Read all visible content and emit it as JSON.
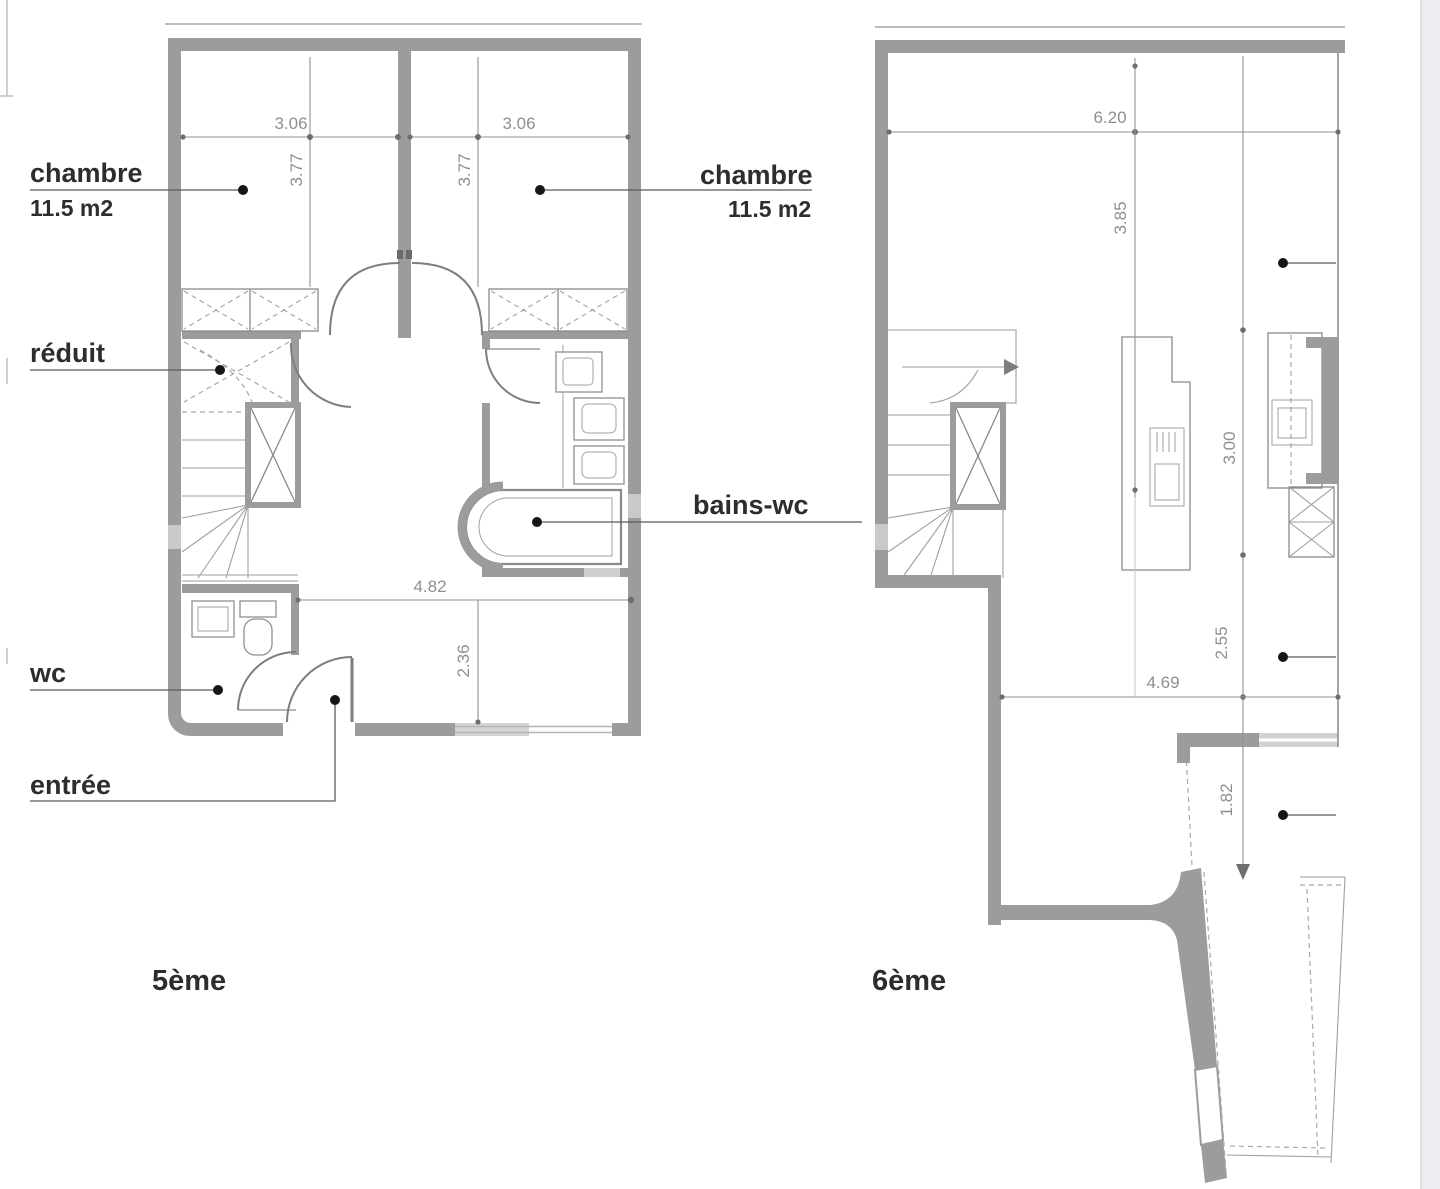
{
  "canvas": {
    "width": 1440,
    "height": 1189,
    "background": "#ffffff"
  },
  "colors": {
    "wall": "#9c9c9c",
    "wall_light": "#c9c9c9",
    "line": "#8a8a8a",
    "label_text": "#2d2d2d",
    "dim_text": "#8f8f8f",
    "leader_dot": "#161616",
    "edge_strip": "#ecedf1"
  },
  "left_plan": {
    "floor_label": "5ème",
    "labels": {
      "chambre_left": "chambre",
      "chambre_left_area": "11.5 m2",
      "chambre_right": "chambre",
      "chambre_right_area": "11.5 m2",
      "reduit": "réduit",
      "bains_wc": "bains-wc",
      "wc": "wc",
      "entree": "entrée"
    },
    "dims": {
      "room_left_width": "3.06",
      "room_right_width": "3.06",
      "room_left_depth": "3.77",
      "room_right_depth": "3.77",
      "corridor_width": "4.82",
      "corridor_depth": "2.36"
    }
  },
  "right_plan": {
    "floor_label": "6ème",
    "dims": {
      "living_width": "6.20",
      "living_depth": "3.85",
      "kitchen_depth": "3.00",
      "dining_depth": "2.55",
      "terrace_width": "4.69",
      "terrace_depth": "1.82"
    }
  }
}
